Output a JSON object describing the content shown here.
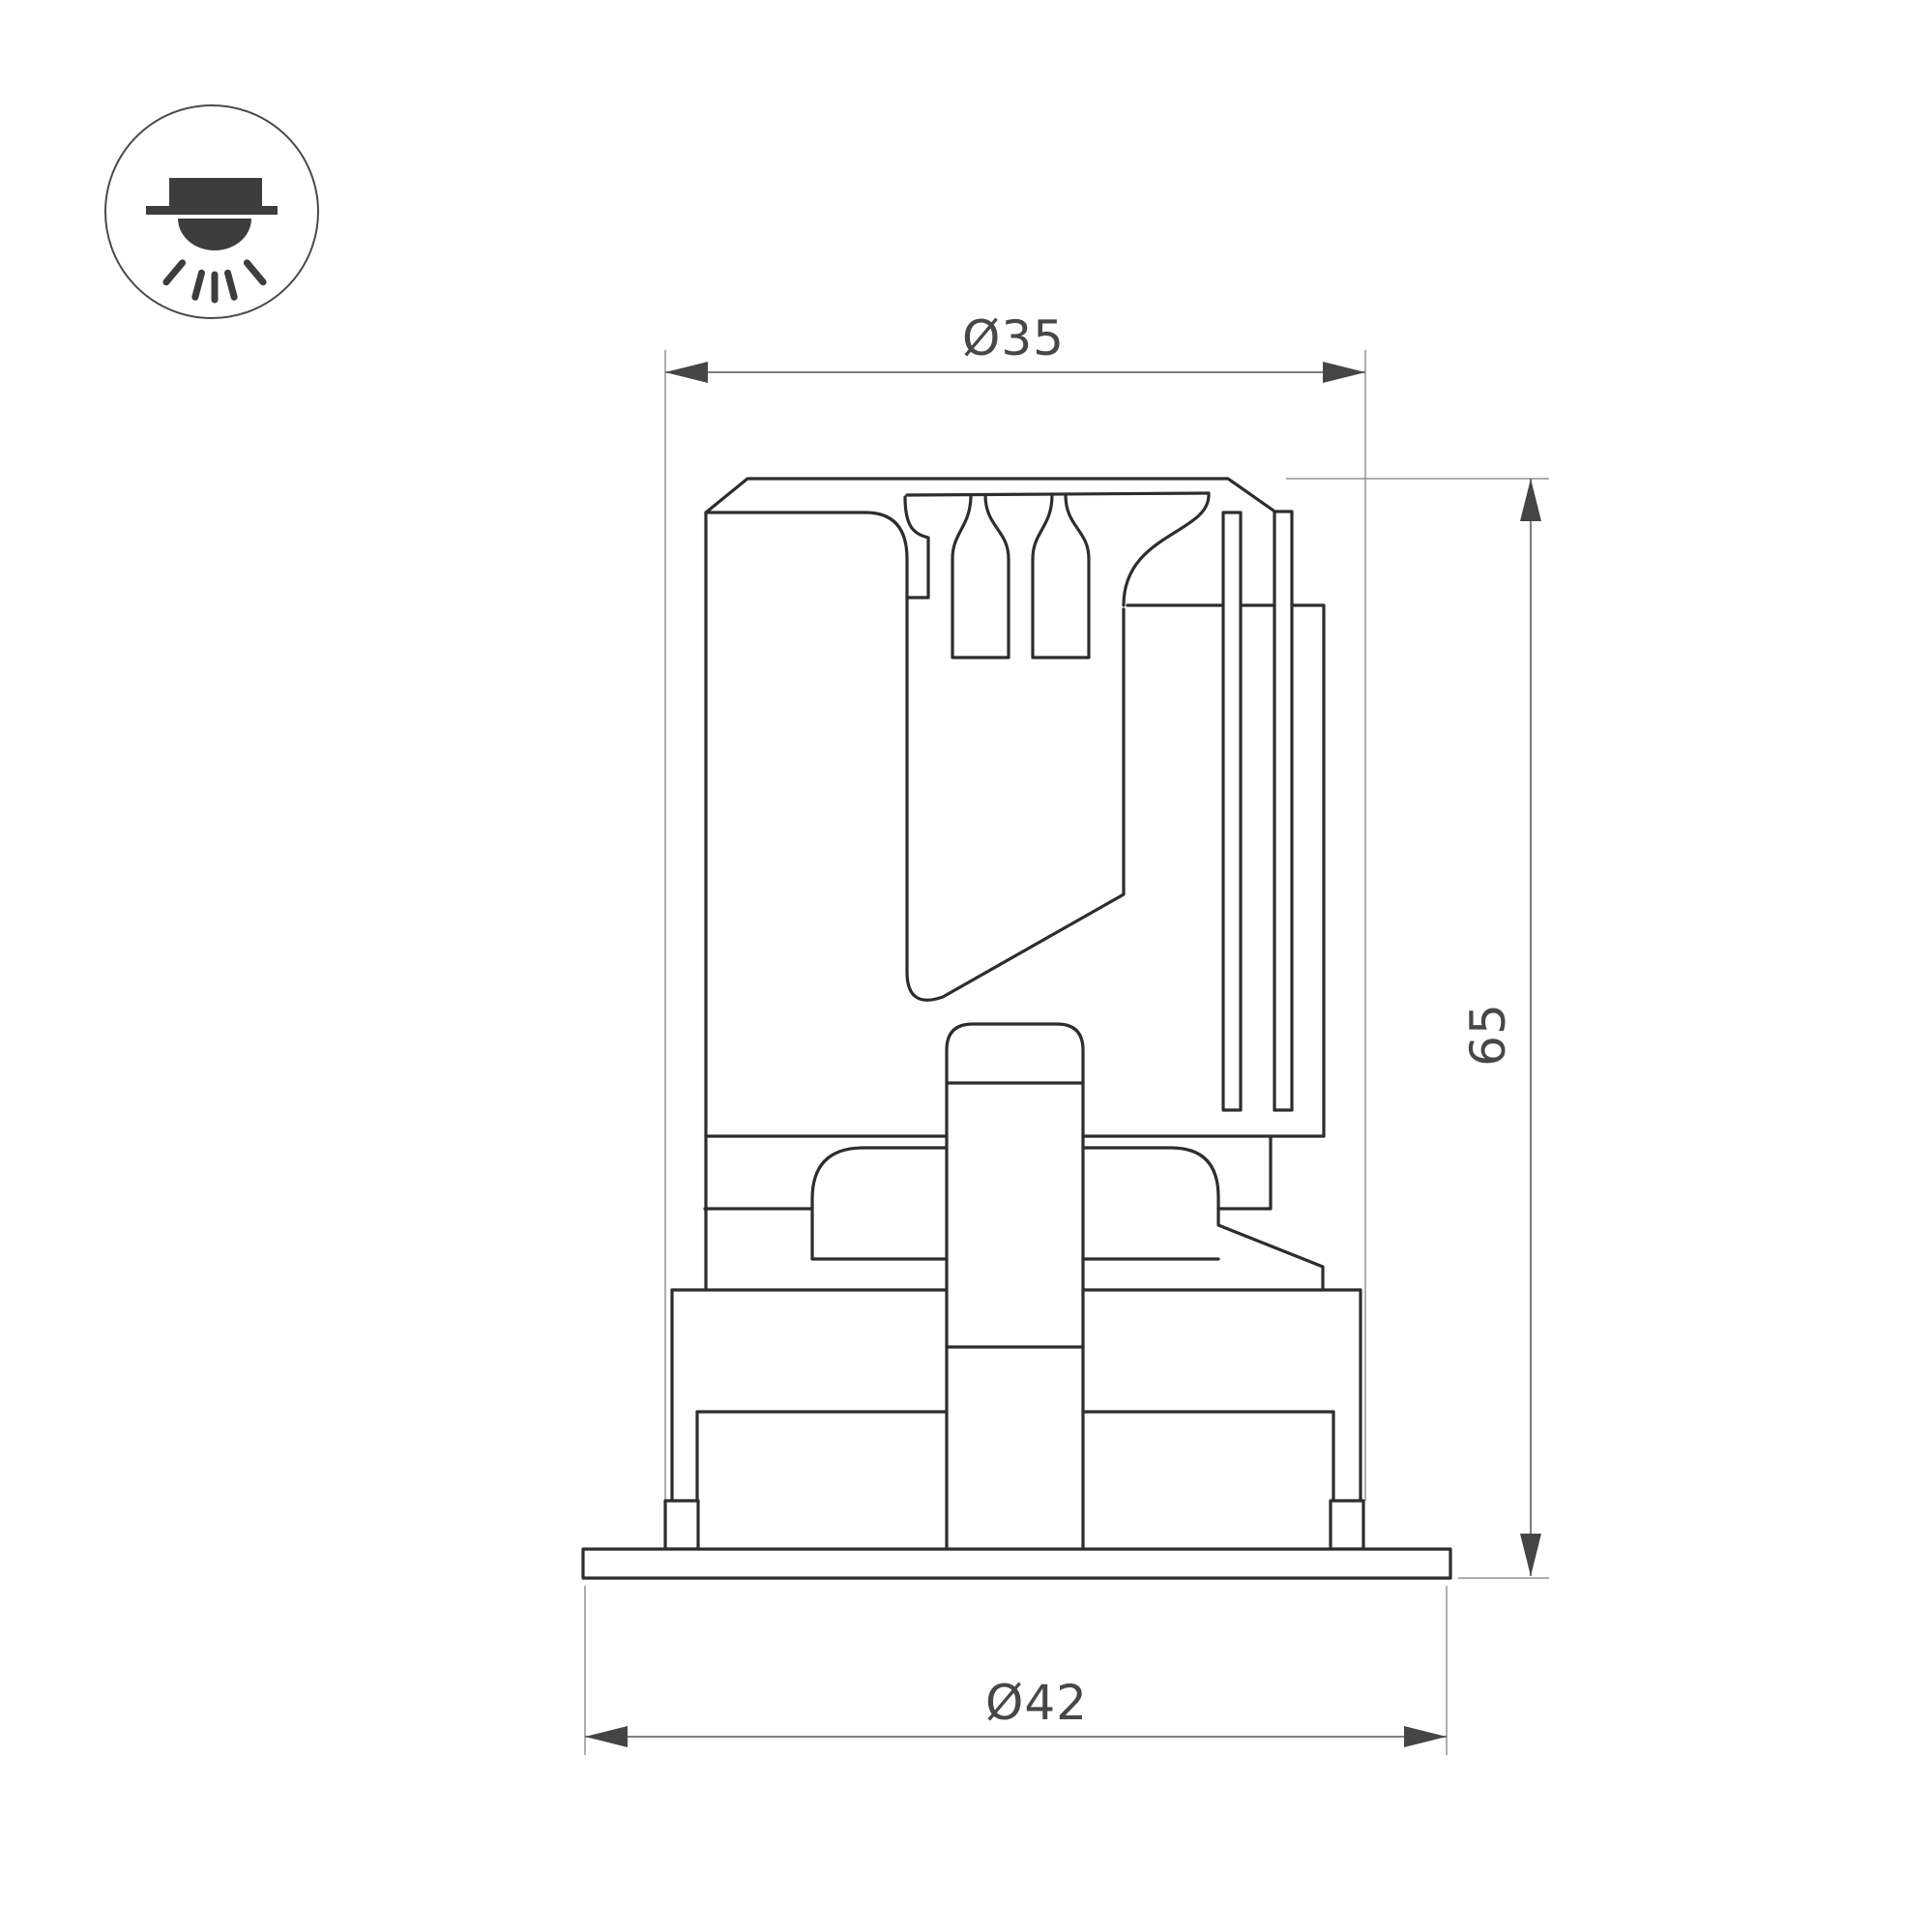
{
  "drawing": {
    "icon": {
      "name": "recessed-downlight-icon",
      "description": "circled pictogram of a recessed ceiling downlight emitting light rays downward"
    },
    "labels": {
      "top_diameter": "Ø35",
      "height": "65",
      "bottom_diameter": "Ø42"
    },
    "colors": {
      "object_line": "#2d2d2d",
      "dimension_line": "#6e6e6e",
      "extension_line": "#949494",
      "text": "#474747",
      "icon_fill": "#3d3d3d",
      "background": "#ffffff"
    }
  }
}
